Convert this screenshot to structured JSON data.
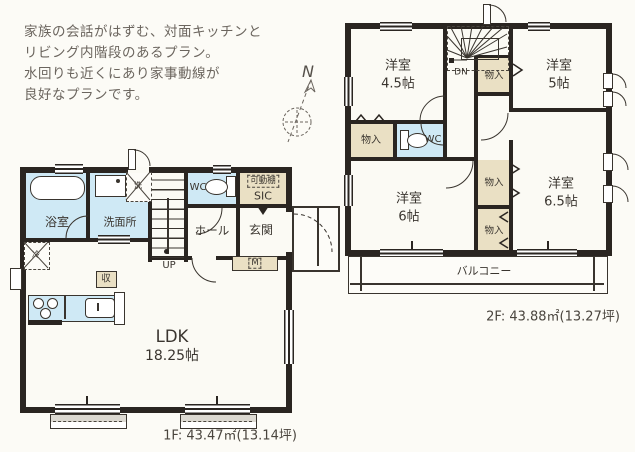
{
  "colors": {
    "wall": "#2a2521",
    "water_room": "#cfe9f5",
    "closet": "#eae0c4",
    "floor": "#fcfbf6",
    "text": "#3a352f",
    "description_text": "#6b655e"
  },
  "description": {
    "lines": [
      "家族の会話がはずむ、対面キッチンと",
      "リビング内階段のあるプラン。",
      "水回りも近くにあり家事動線が",
      "良好なプランです。"
    ]
  },
  "compass": {
    "north_label": "N"
  },
  "floor1": {
    "area_label": "1F: 43.47㎡(13.14坪)",
    "labels": {
      "bath": "浴室",
      "washroom": "洗面所",
      "wc": "WC",
      "hall": "ホール",
      "entrance": "玄関",
      "movable_shelf": "可動棚",
      "sic": "SIC",
      "stairs_up": "UP",
      "storage": "収",
      "meter": "M",
      "washer": "洗",
      "fridge": "冷",
      "ldk": "LDK",
      "ldk_size": "18.25帖"
    }
  },
  "floor2": {
    "area_label": "2F: 43.88㎡(13.27坪)",
    "labels": {
      "stairs_down": "DN",
      "wc": "WC",
      "balcony": "バルコニー",
      "room_a": "洋室",
      "room_a_size": "4.5帖",
      "room_b": "洋室",
      "room_b_size": "5帖",
      "room_c": "洋室",
      "room_c_size": "6帖",
      "room_d": "洋室",
      "room_d_size": "6.5帖",
      "closet_stair": "物入",
      "closet_west": "物入",
      "closet_mid_upper": "物入",
      "closet_mid_lower": "物入"
    }
  }
}
